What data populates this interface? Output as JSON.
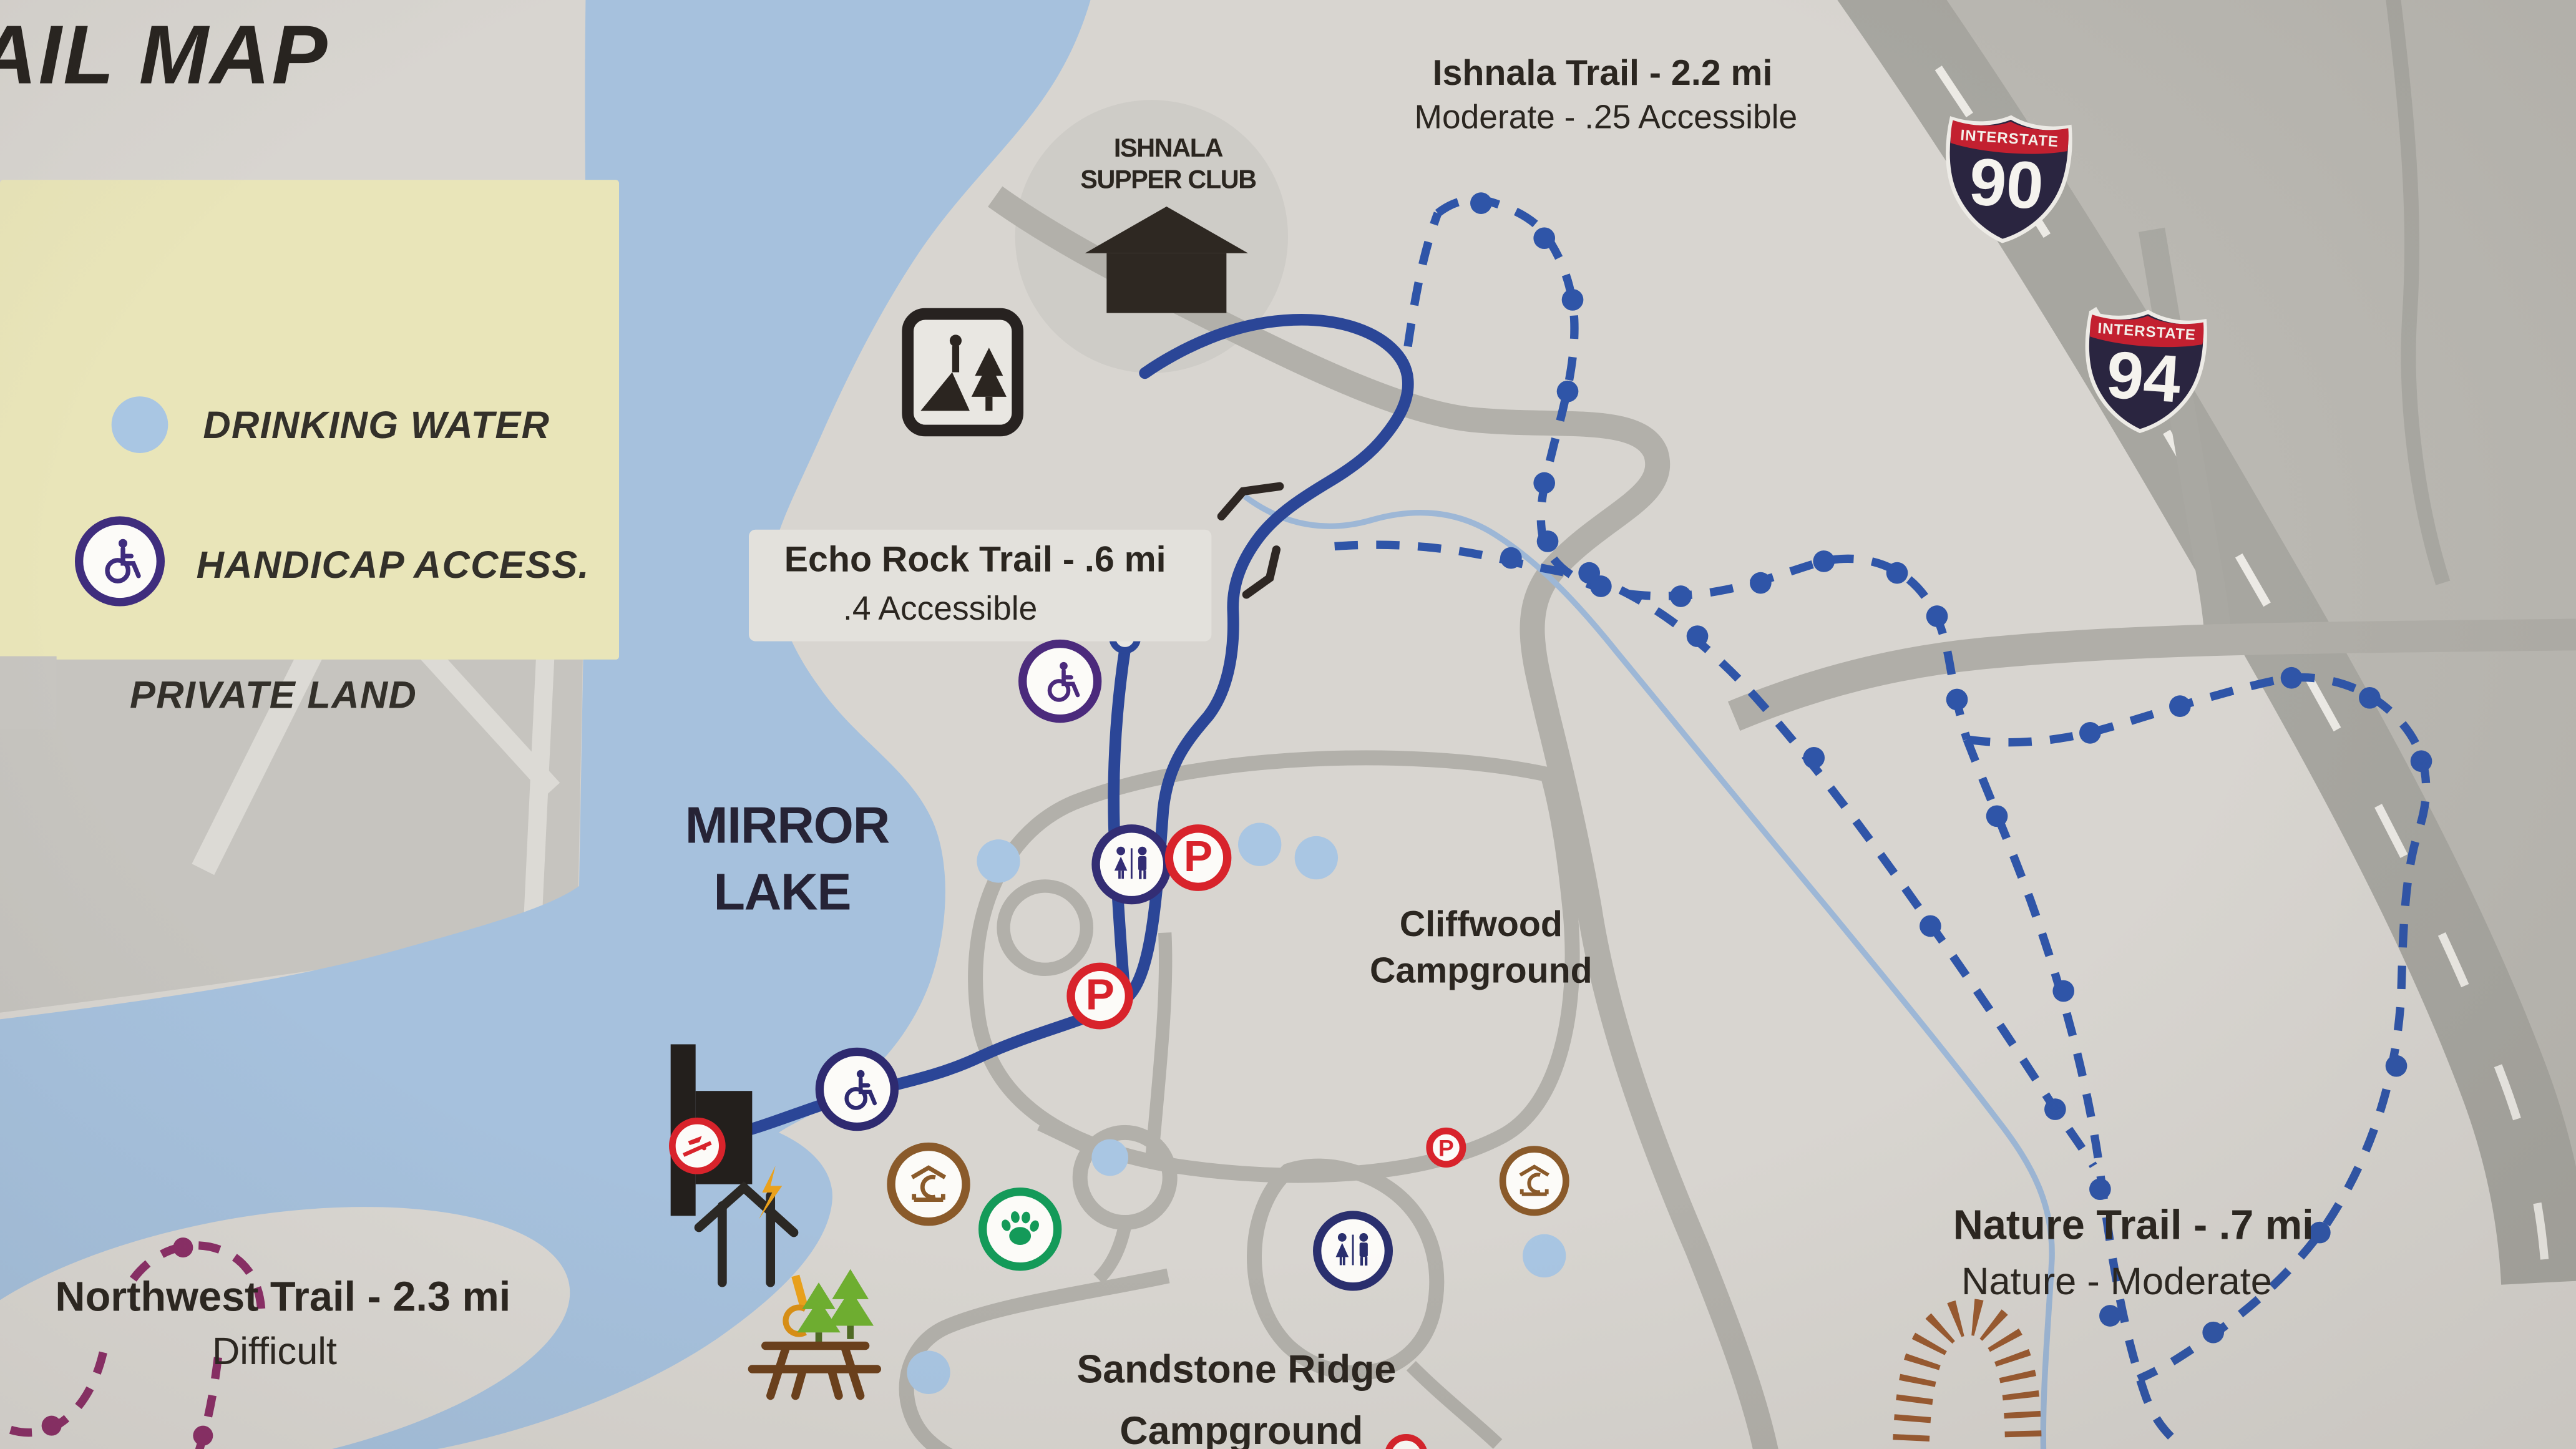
{
  "title": "AIL MAP",
  "legend": {
    "items": [
      {
        "label": "DRINKING WATER",
        "icon": "drinking-water-dot"
      },
      {
        "label": "HANDICAP ACCESS.",
        "icon": "handicap-access-badge"
      },
      {
        "label": "PRIVATE LAND",
        "icon": "private-land-swatch"
      }
    ]
  },
  "labels": {
    "ishnala_trail": {
      "line1": "Ishnala Trail - 2.2 mi",
      "line2": "Moderate - .25 Accessible"
    },
    "supper_club": {
      "line1": "ISHNALA",
      "line2": "SUPPER CLUB"
    },
    "echo_rock": {
      "line1": "Echo Rock Trail - .6 mi",
      "line2": ".4 Accessible"
    },
    "mirror_lake": {
      "line1": "MIRROR",
      "line2": "LAKE"
    },
    "cliffwood": {
      "line1": "Cliffwood",
      "line2": "Campground"
    },
    "sandstone": {
      "line1": "Sandstone Ridge",
      "line2": "Campground"
    },
    "northwest": {
      "line1": "Northwest Trail - 2.3 mi",
      "line2": "Difficult"
    },
    "nature": {
      "line1": "Nature Trail - .7 mi",
      "line2": "Nature - Moderate"
    }
  },
  "shields": [
    {
      "top": "INTERSTATE",
      "number": "90"
    },
    {
      "top": "INTERSTATE",
      "number": "94"
    }
  ],
  "icons": [
    "overlook-sign-icon",
    "supper-club-building-icon",
    "drinking-water-dot",
    "handicap-access-icon",
    "restroom-icon",
    "parking-icon",
    "boat-launch-icon",
    "shelter-icon",
    "pet-area-paw-icon",
    "picnic-table-icon",
    "pine-tree-icon",
    "power-pole-icon",
    "electric-hookup-icon",
    "dam-structure",
    "bridge-marker",
    "railroad-track",
    "trailhead-circle"
  ],
  "colors": {
    "paper": "#d8d5d0",
    "lake": "#a6c1dd",
    "legend_bg": "#e9e5b9",
    "private_grey": "#c6c4bf",
    "outside_grey": "#bab8b2",
    "road": "#b2b0aa",
    "highway": "#a7a6a0",
    "trail_solid": "#2b4697",
    "trail_dashed": "#2f55a8",
    "trail_purple": "#8a2e66",
    "stream": "#9db7d6",
    "railroad": "#9a5a30",
    "red": "#d8232b",
    "green": "#149a59",
    "brown": "#8a5a2a",
    "icon_navy": "#2e2a70",
    "icon_purple": "#4b2a7c",
    "text": "#2b2620"
  }
}
